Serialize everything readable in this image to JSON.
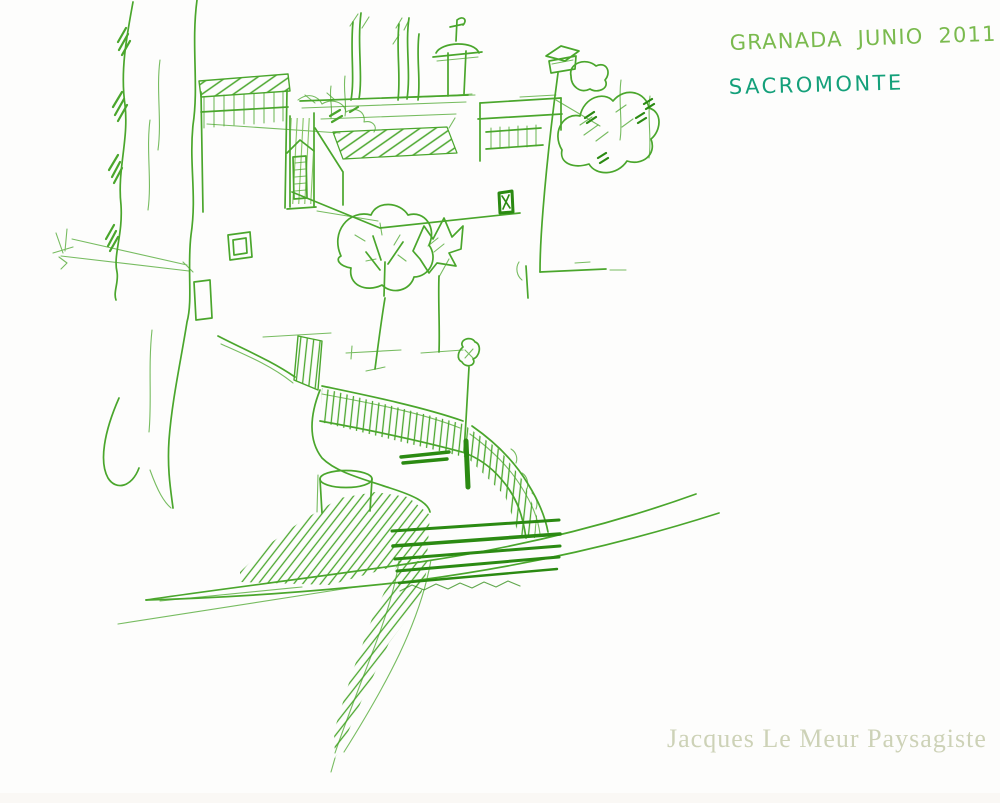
{
  "artwork": {
    "annotations": {
      "line1": "GRANADA JUNIO 2011",
      "line2": "SACROMONTE"
    },
    "watermark": "Jacques Le Meur Paysagiste",
    "colors": {
      "paper": "#fdfdfc",
      "ink": "#4aa62c",
      "ink_dark": "#2b8a12",
      "ink_light": "#82c25e",
      "annotation_green": "#7aba4e",
      "annotation_teal": "#14a07a",
      "watermark": "#cdd2b7"
    }
  }
}
